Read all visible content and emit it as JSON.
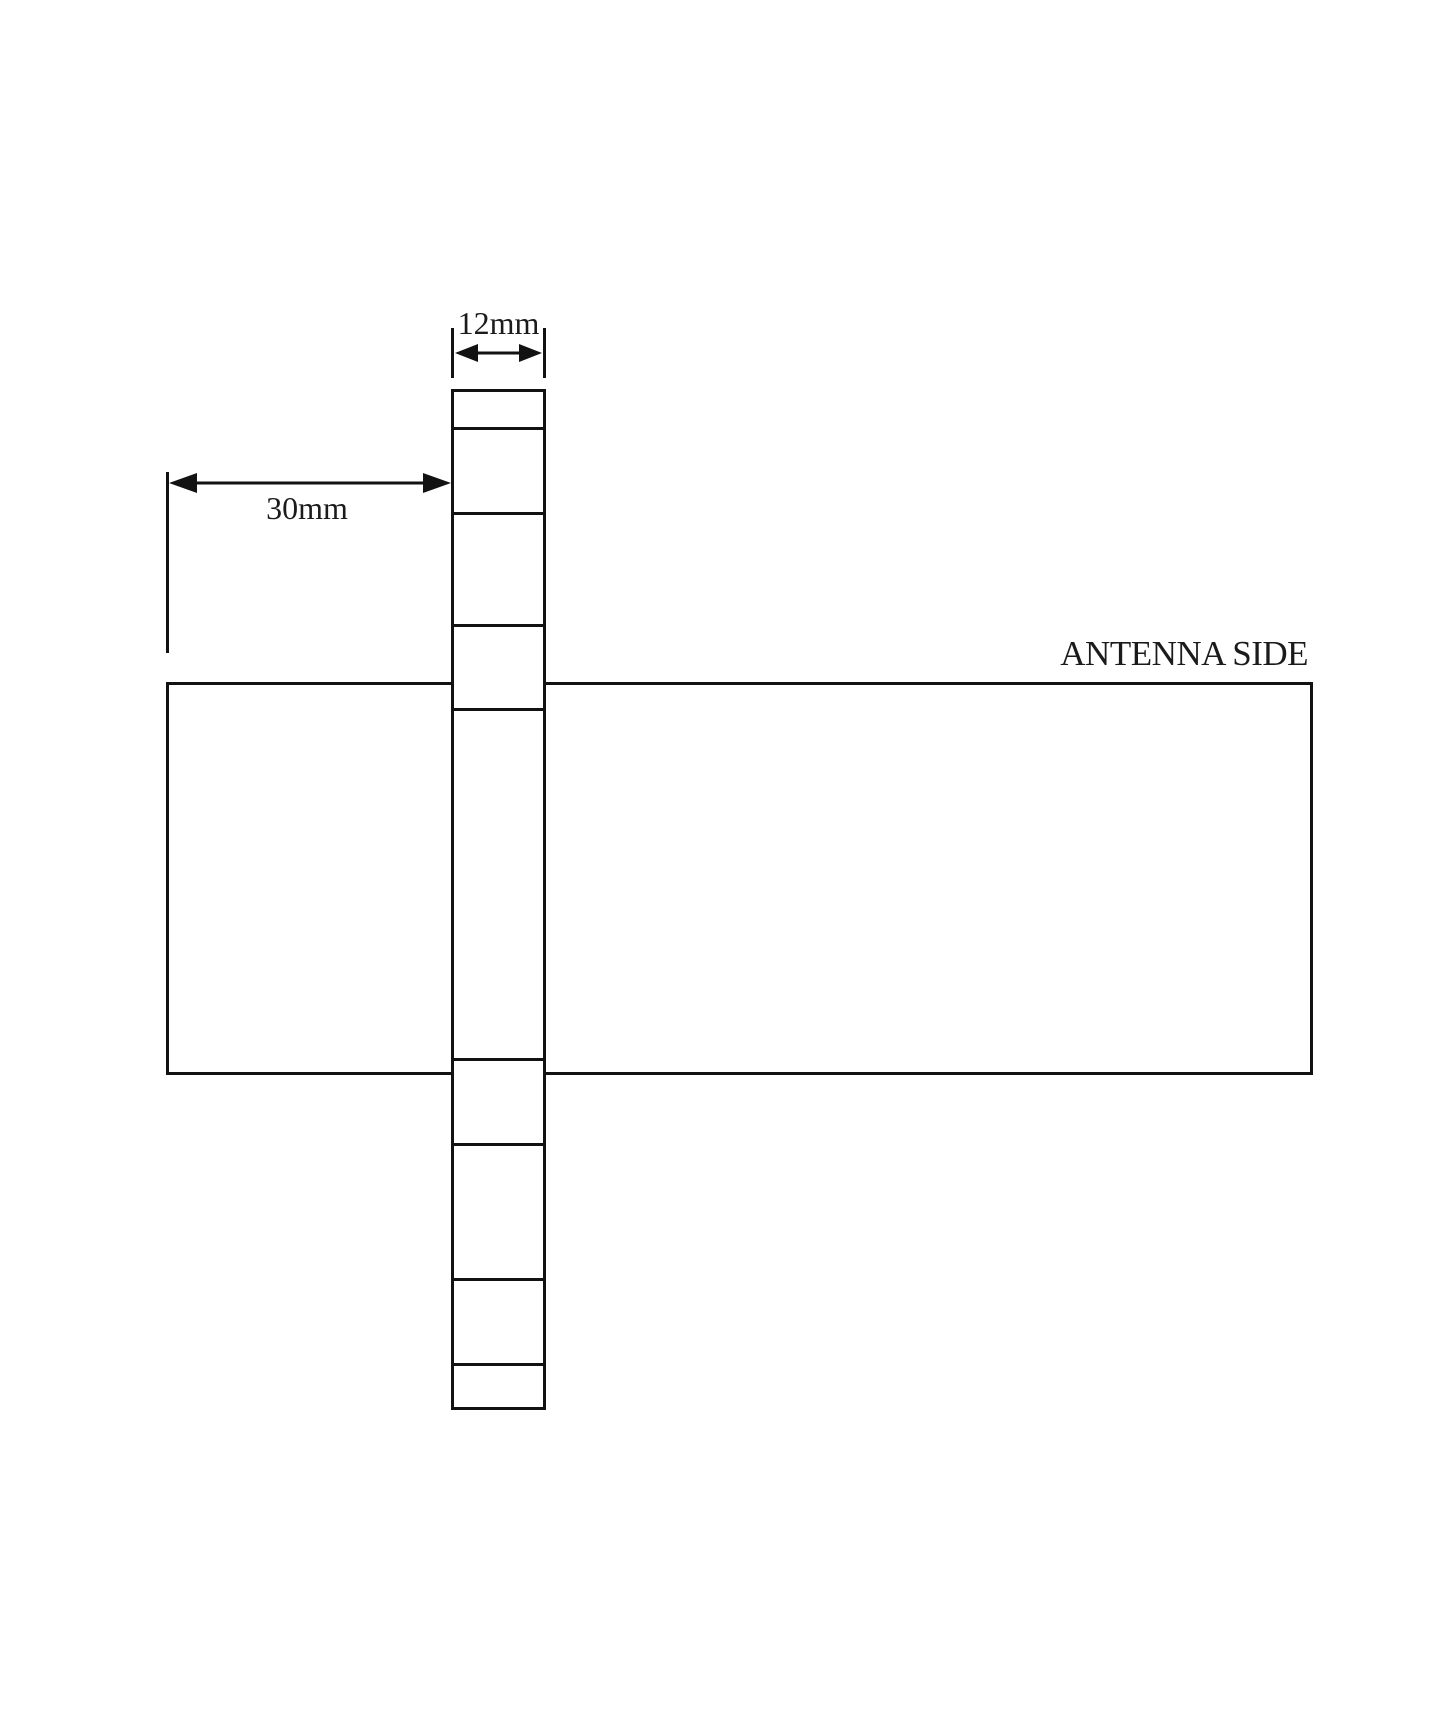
{
  "diagram": {
    "type": "technical-dimension-drawing",
    "labels": {
      "strip_width": "12mm",
      "strip_offset": "30mm",
      "antenna_side": "ANTENNA SIDE"
    },
    "colors": {
      "background": "#ffffff",
      "line": "#121212",
      "text": "#1b1b1b"
    },
    "strip_segment_count": "9"
  }
}
